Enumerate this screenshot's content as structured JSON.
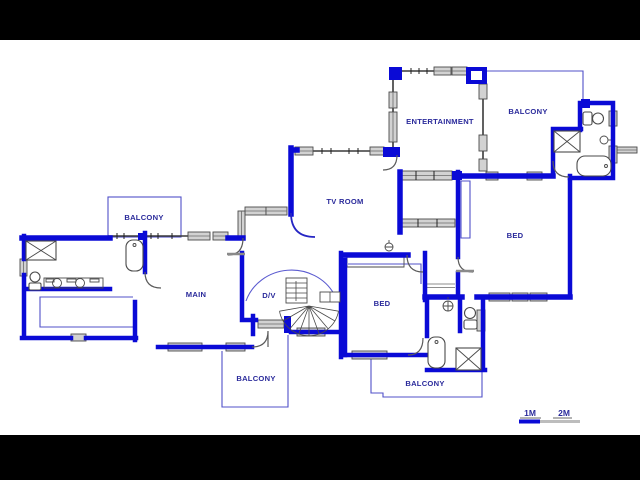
{
  "plan": {
    "rooms": [
      {
        "id": "entertainment",
        "label": "ENTERTAINMENT"
      },
      {
        "id": "balcony-top-right",
        "label": "BALCONY"
      },
      {
        "id": "balcony-top-left",
        "label": "BALCONY"
      },
      {
        "id": "tv-room",
        "label": "TV ROOM"
      },
      {
        "id": "bed-right",
        "label": "BED"
      },
      {
        "id": "main",
        "label": "MAIN"
      },
      {
        "id": "dv",
        "label": "D/V"
      },
      {
        "id": "bed-center",
        "label": "BED"
      },
      {
        "id": "balcony-bottom-center",
        "label": "BALCONY"
      },
      {
        "id": "balcony-bottom-right",
        "label": "BALCONY"
      }
    ],
    "scale": {
      "one": "1M",
      "two": "2M"
    },
    "colors": {
      "wall_blue": "#0a0ad6",
      "label_navy": "#2a2a9b",
      "window_gray": "#d2d2d2",
      "scale_gray": "#bdbdbd",
      "background": "#ffffff",
      "letterbox": "#000000"
    }
  }
}
